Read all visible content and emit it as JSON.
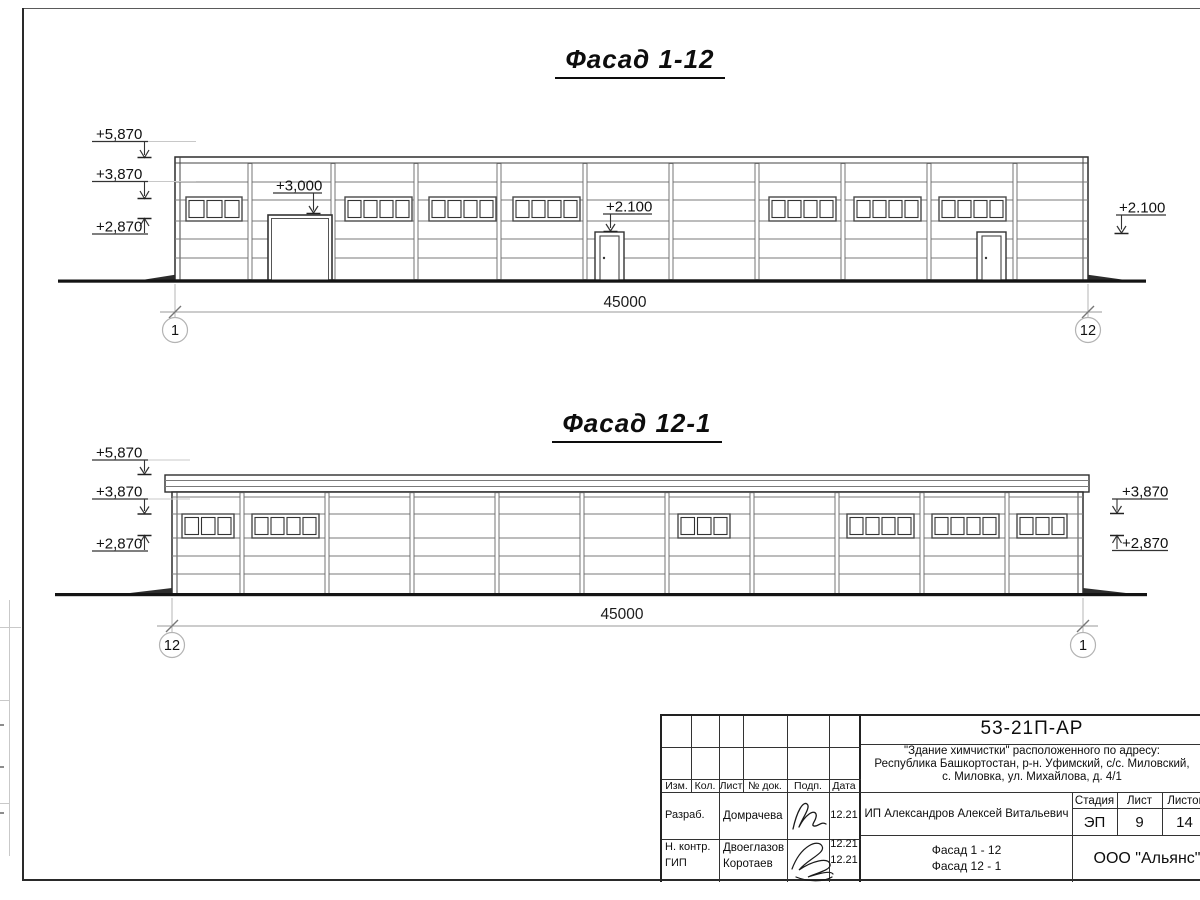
{
  "facade1": {
    "title": "Фасад 1-12",
    "dim": "45000",
    "axis_left": "1",
    "axis_right": "12",
    "mark_top": "+5,870",
    "mark_mid": "+3,870",
    "mark_low": "+2,870",
    "mark_gate": "+3,000",
    "mark_door": "+2.100",
    "mark_right": "+2.100"
  },
  "facade2": {
    "title": "Фасад 12-1",
    "dim": "45000",
    "axis_left": "12",
    "axis_right": "1",
    "mark_top": "+5,870",
    "mark_mid": "+3,870",
    "mark_low": "+2,870",
    "mark_right_top": "+3,870",
    "mark_right_low": "+2,870"
  },
  "titleblock": {
    "doc_code": "53-21П-АР",
    "address_line1": "\"Здание химчистки\" расположенного по адресу:",
    "address_line2": "Республика Башкортостан, р-н. Уфимский, с/с. Миловский,",
    "address_line3": "с. Миловка, ул. Михайлова, д. 4/1",
    "headers": {
      "izm": "Изм.",
      "kol": "Кол.",
      "list": "Лист",
      "ndok": "№ док.",
      "podp": "Подп.",
      "data": "Дата"
    },
    "rows": [
      {
        "role": "Разраб.",
        "name": "Домрачева",
        "date": "12.21"
      },
      {
        "role": "Н. контр.",
        "name": "Двоеглазов",
        "date": "12.21"
      },
      {
        "role": "ГИП",
        "name": "Коротаев",
        "date": "12.21"
      }
    ],
    "client": "ИП Александров Алексей Витальевич",
    "stage_header": "Стадия",
    "list_header": "Лист",
    "listov_header": "Листов",
    "stage": "ЭП",
    "list_no": "9",
    "listov": "14",
    "content_line1": "Фасад 1 - 12",
    "content_line2": "Фасад 12 - 1",
    "company": "ООО \"Альянс\""
  }
}
